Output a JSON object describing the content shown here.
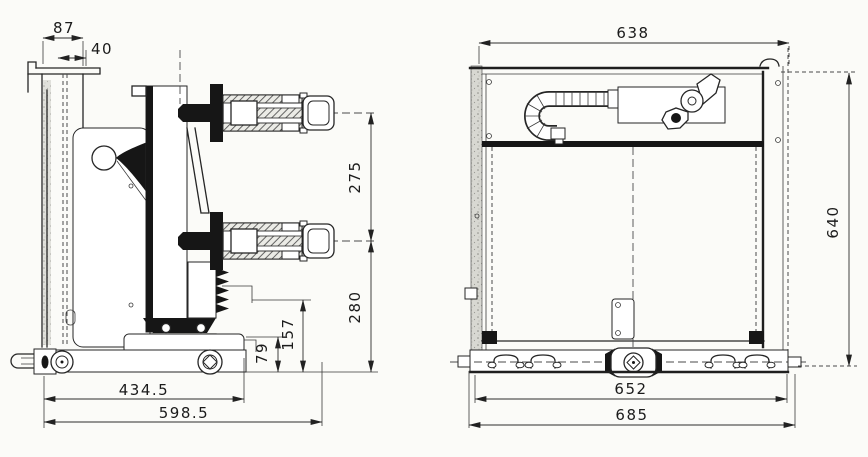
{
  "colors": {
    "paper": "#fbfbf8",
    "ink": "#1e1e1e"
  },
  "dimensions": {
    "left_view": [
      {
        "id": "flange-width",
        "value": "87"
      },
      {
        "id": "flange-offset",
        "value": "40"
      },
      {
        "id": "terminal-centerline-spacing",
        "value": "275"
      },
      {
        "id": "lower-terminal-height",
        "value": "280"
      },
      {
        "id": "bracket-height",
        "value": "157"
      },
      {
        "id": "base-step-height",
        "value": "79"
      },
      {
        "id": "frame-depth",
        "value": "434.5"
      },
      {
        "id": "overall-depth",
        "value": "598.5"
      }
    ],
    "right_view": [
      {
        "id": "enclosure-width",
        "value": "638"
      },
      {
        "id": "overall-height",
        "value": "640"
      },
      {
        "id": "base-width",
        "value": "652"
      },
      {
        "id": "overall-width",
        "value": "685"
      }
    ]
  }
}
